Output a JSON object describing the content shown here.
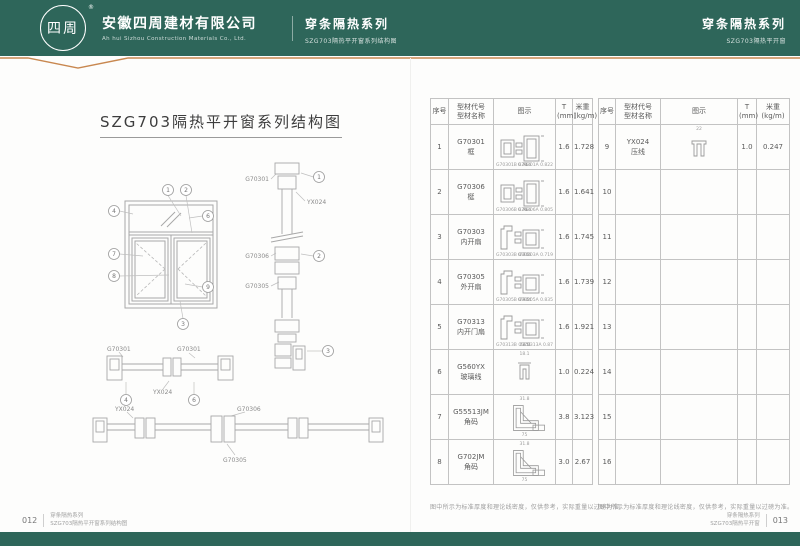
{
  "header": {
    "logo_text": "四周",
    "registered_mark": "®",
    "company_cn": "安徽四周建材有限公司",
    "company_en": "Ah hui Sizhou Construction Materials Co., Ltd.",
    "center_series": "穿条隔热系列",
    "center_sub": "SZG703隔热平开窗系列结构图",
    "right_series": "穿条隔热系列",
    "right_sub": "SZG703隔热平开窗"
  },
  "left_page": {
    "title": "SZG703隔热平开窗系列结构图",
    "diagram": {
      "labels": {
        "vs_frame": "G70301",
        "vs_clip": "YX024",
        "vs_mullion": "G70306",
        "vs_sash": "G70305",
        "hs1_left": "G70301",
        "hs1_right": "G70301",
        "hs1_clip": "YX024",
        "hs2_clip": "YX024",
        "hs2_mullion": "G70306",
        "hs2_sash": "G70305"
      },
      "callouts": {
        "e1": "1",
        "e2": "2",
        "e3": "3",
        "e4": "4",
        "e6": "6",
        "e7": "7",
        "e8": "8",
        "e9": "9",
        "s1": "1",
        "s2": "2",
        "s3": "3",
        "s4": "4",
        "s6": "6"
      }
    },
    "footer": {
      "page_no": "012",
      "series": "穿条隔热系列",
      "sub": "SZG703隔热平开窗系列结构图"
    }
  },
  "right_page": {
    "headers": [
      {
        "line1": "序号"
      },
      {
        "line1": "型材代号",
        "line2": "型材名称"
      },
      {
        "line1": "图示"
      },
      {
        "line1": "T",
        "line2": "(mm)"
      },
      {
        "line1": "米重",
        "line2": "(kg/m)"
      }
    ],
    "note": "图中所示为标准厚度和理论线密度，仅供参考，实际重量以过磅为准。",
    "table1": {
      "rows": [
        {
          "no": "1",
          "code": "G70301",
          "name": "框",
          "t": "1.6",
          "wt": "1.728",
          "shape": "section",
          "sub_left": "G70301B 0.766",
          "sub_mid": "78",
          "sub_right": "G70301A 0.822"
        },
        {
          "no": "2",
          "code": "G70306",
          "name": "梃",
          "t": "1.6",
          "wt": "1.641",
          "shape": "section",
          "sub_left": "G70306B 0.766",
          "sub_mid": "76",
          "sub_right": "G70306A 0.805"
        },
        {
          "no": "3",
          "code": "G70303",
          "name": "内开扇",
          "t": "1.6",
          "wt": "1.745",
          "shape": "sash",
          "sub_left": "G70303B 0.766",
          "sub_mid": "78.5",
          "sub_right": "G70303A 0.719"
        },
        {
          "no": "4",
          "code": "G70305",
          "name": "外开扇",
          "t": "1.6",
          "wt": "1.739",
          "shape": "sash",
          "sub_left": "G70305B 0.904",
          "sub_mid": "78.5",
          "sub_right": "G70305A 0.835"
        },
        {
          "no": "5",
          "code": "G70313",
          "name": "内开门扇",
          "t": "1.6",
          "wt": "1.921",
          "shape": "sash",
          "sub_left": "G70313B 0.851",
          "sub_mid": "78.5",
          "sub_right": "G70313A 0.87"
        },
        {
          "no": "6",
          "code": "G560YX",
          "name": "玻璃线",
          "t": "1.0",
          "wt": "0.224",
          "shape": "clip",
          "dim_top": "18.1"
        },
        {
          "no": "7",
          "code": "G55513JM",
          "name": "角码",
          "t": "3.8",
          "wt": "3.123",
          "shape": "corner",
          "dim_top": "31.8",
          "sub_mid": "75"
        },
        {
          "no": "8",
          "code": "G702JM",
          "name": "角码",
          "t": "3.0",
          "wt": "2.67",
          "shape": "corner",
          "dim_top": "31.8",
          "sub_mid": "75"
        }
      ]
    },
    "table2": {
      "rows": [
        {
          "no": "9",
          "code": "YX024",
          "name": "压线",
          "t": "1.0",
          "wt": "0.247",
          "shape": "clip2",
          "dim_top": "22"
        },
        {
          "no": "10"
        },
        {
          "no": "11"
        },
        {
          "no": "12"
        },
        {
          "no": "13"
        },
        {
          "no": "14"
        },
        {
          "no": "15"
        },
        {
          "no": "16"
        }
      ]
    },
    "footer": {
      "page_no": "013",
      "series": "穿条隔热系列",
      "sub": "SZG703隔热平开窗"
    }
  },
  "colors": {
    "header_green": "#2E665A",
    "accent_orange": "#C8874F"
  }
}
